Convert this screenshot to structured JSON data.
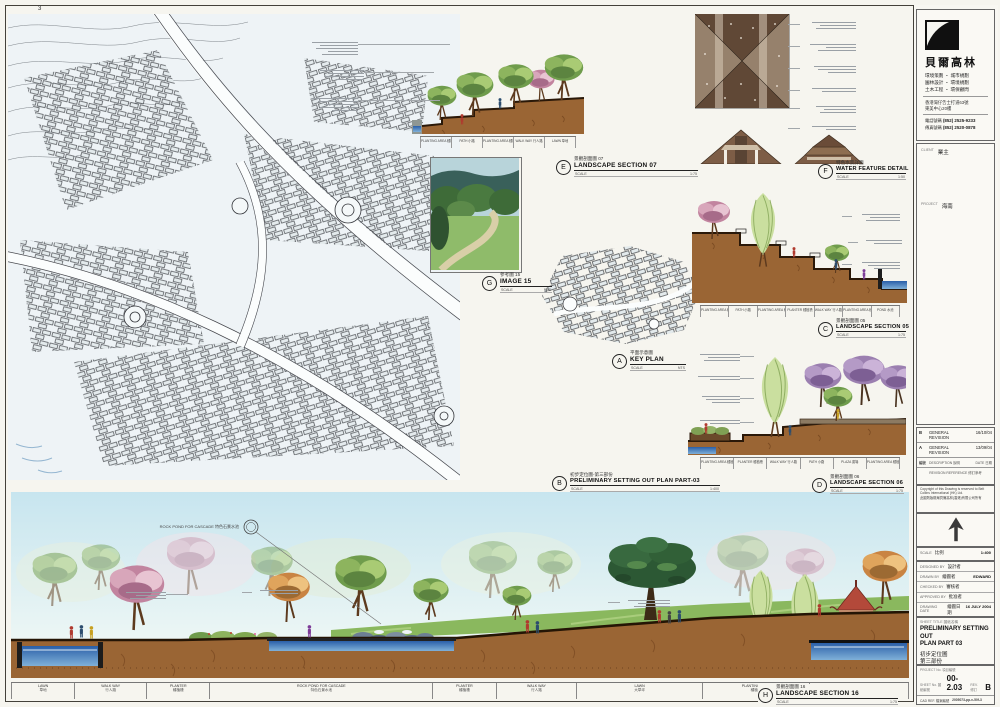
{
  "sheet": {
    "page_marker": "3"
  },
  "company": {
    "name": "貝爾高林",
    "services": [
      "環境策劃 ・ 城市規劃",
      "園林設計 ・ 環境規劃",
      "土木工程 ・ 環保顧問"
    ],
    "address1": "香港灣仔告士打道63號",
    "address2": "東美中心20樓",
    "tel_label": "電話號碼",
    "tel_value": "(852) 2525-9233",
    "fax_label": "傳真號碼",
    "fax_value": "(852) 2520-0878"
  },
  "fields": {
    "client_label": "CLIENT",
    "client_value": "業主",
    "project_label": "PROJECT",
    "project_value": "海南"
  },
  "revisions": {
    "rows": [
      {
        "rev": "B",
        "desc": "GENERAL REVISION",
        "date": "16/10/04"
      },
      {
        "rev": "A",
        "desc": "GENERAL REVISION",
        "date": "13/09/04"
      }
    ],
    "header_rev": "編號",
    "header_desc": "DESCRIPTION 說明",
    "header_date": "DATE 日期",
    "footer": "REVISION REFERENCE 修訂參考"
  },
  "copyright": {
    "en": "Copyright of this Drawing is reserved to Belt Collins International (HK) Ltd.",
    "cn": "此圖則版權屬貝爾高林(香港)有限公司所有"
  },
  "scale_block": {
    "label": "SCALE",
    "cn": "比例",
    "value": "1:400"
  },
  "credits": [
    {
      "label": "DESIGNED BY",
      "cn": "設計者",
      "value": ""
    },
    {
      "label": "DRAWN BY",
      "cn": "繪圖者",
      "value": "EDWARD"
    },
    {
      "label": "CHECKED BY",
      "cn": "審核者",
      "value": ""
    },
    {
      "label": "APPROVED BY",
      "cn": "批准者",
      "value": ""
    },
    {
      "label": "DRAWING DATE",
      "cn": "繪圖日期",
      "value": "16 JULY 2004"
    }
  ],
  "title_box": {
    "label": "SHEET TITLE 圖紙名稱",
    "en1": "PRELIMINARY SETTING OUT",
    "en2": "PLAN PART 03",
    "cn1": "初步定位圖",
    "cn2": "第三部份"
  },
  "numbers": {
    "project_no_label": "PROJECT No. 項目編號",
    "sheet_no_label": "SHEET No. 圖紙編號",
    "sheet_no": "00-2.03",
    "rev_label": "REV. 修訂",
    "rev": "B",
    "cad_label": "CAD REF. 檔案編號",
    "cad": "2005073-pp-v-50f-3"
  },
  "callouts": {
    "A": {
      "letter": "A",
      "cn": "平面示意圖",
      "en": "KEY PLAN",
      "scale_label": "SCALE",
      "scale": "NTS"
    },
    "B": {
      "letter": "B",
      "cn": "初步定位圖-第三部份",
      "en": "PRELIMINARY SETTING OUT PLAN PART-03",
      "scale_label": "SCALE",
      "scale": "1:400"
    },
    "C": {
      "letter": "C",
      "cn": "景觀剖面圖 05",
      "en": "LANDSCAPE SECTION 05",
      "scale_label": "SCALE",
      "scale": "1:75"
    },
    "D": {
      "letter": "D",
      "cn": "景觀剖面圖 06",
      "en": "LANDSCAPE SECTION 06",
      "scale_label": "SCALE",
      "scale": "1:75"
    },
    "E": {
      "letter": "E",
      "cn": "景觀剖面圖 07",
      "en": "LANDSCAPE SECTION 07",
      "scale_label": "SCALE",
      "scale": "1:75"
    },
    "F": {
      "letter": "F",
      "cn": "特色水景詳圖",
      "en": "WATER FEATURE DETAIL",
      "scale_label": "SCALE",
      "scale": "1:50"
    },
    "G": {
      "letter": "G",
      "cn": "參考圖 15",
      "en": "IMAGE 15",
      "scale_label": "SCALE",
      "scale": "NTS"
    },
    "H": {
      "letter": "H",
      "cn": "景觀剖面圖 16",
      "en": "LANDSCAPE SECTION 16",
      "scale_label": "SCALE",
      "scale": "1:75"
    }
  },
  "pano_note": "ROCK POND FOR CASCADE 特色石景水池",
  "pano_strip": [
    {
      "en": "LAWN",
      "cn": "草地"
    },
    {
      "en": "WALK WAY",
      "cn": "行人路"
    },
    {
      "en": "PLANTER",
      "cn": "種植槽"
    },
    {
      "en": "ROCK POND FOR CASCADE",
      "cn": "特色石景水池"
    },
    {
      "en": "PLANTER",
      "cn": "種植槽"
    },
    {
      "en": "WALK WAY",
      "cn": "行人路"
    },
    {
      "en": "LAWN",
      "cn": "大草坪"
    },
    {
      "en": "PLANTING AREA",
      "cn": "種植區"
    },
    {
      "en": "POND",
      "cn": "水池"
    }
  ],
  "mini_strips": {
    "s07": [
      "PLANTING AREA 種植區",
      "PATH 小路",
      "PLANTING AREA 種植區",
      "WALK WAY 行人路",
      "LAWN 草地"
    ],
    "s05": [
      "PLANTING AREA 種植區",
      "PATH 小路",
      "PLANTING AREA 種植區",
      "PLANTER 種植槽",
      "WALK WAY 行人路",
      "PLANTING AREA 種植區",
      "POND 水池"
    ],
    "s06": [
      "PLANTING AREA 種植區",
      "PLANTER 種植槽",
      "WALK WAY 行人路",
      "PATH 小路",
      "PLAZA 廣場",
      "PLANTING AREA 種植區"
    ]
  }
}
